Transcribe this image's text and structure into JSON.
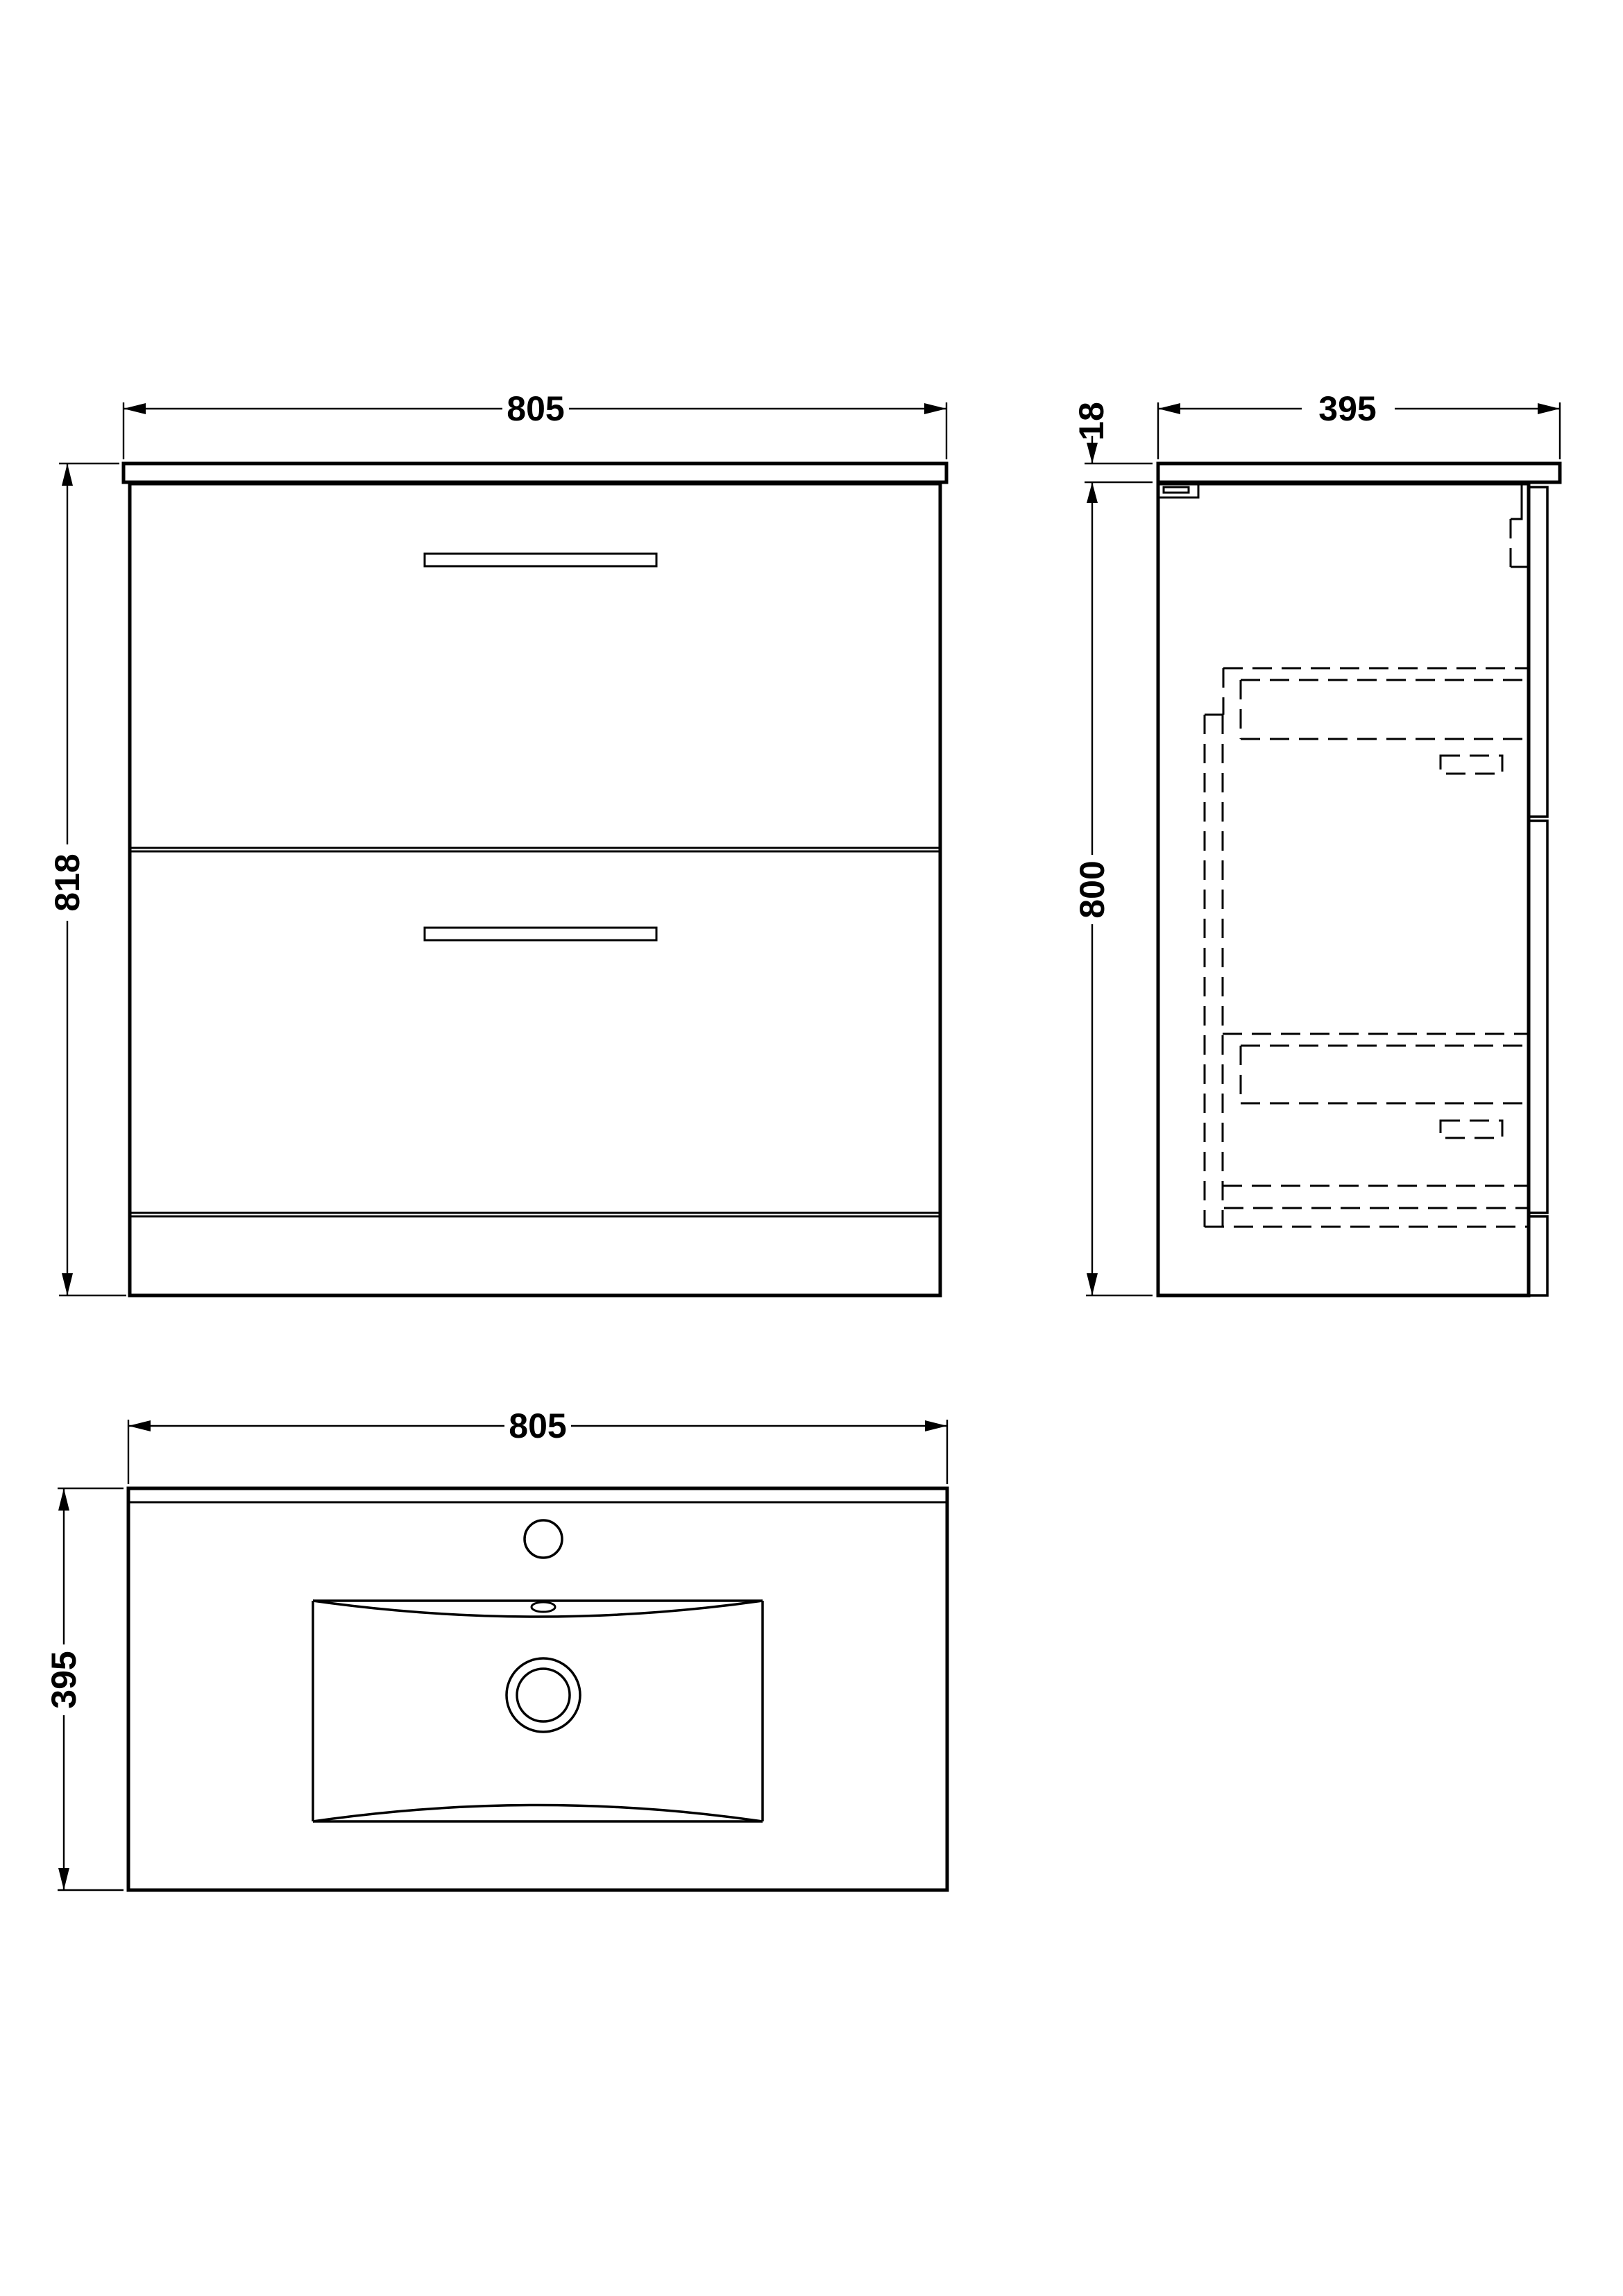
{
  "drawing": {
    "type": "technical-orthographic-drawing",
    "subject": "floor-standing two-drawer vanity unit with basin",
    "background_color": "#ffffff",
    "line_color": "#000000",
    "views": {
      "front_elevation": {
        "name": "front elevation",
        "dims": {
          "width": "805",
          "height": "818"
        }
      },
      "side_section": {
        "name": "side section",
        "dims": {
          "worktop_thickness": "18",
          "depth": "395",
          "carcass_height": "800"
        }
      },
      "plan": {
        "name": "plan view with basin",
        "dims": {
          "width": "805",
          "depth": "395"
        }
      }
    }
  }
}
